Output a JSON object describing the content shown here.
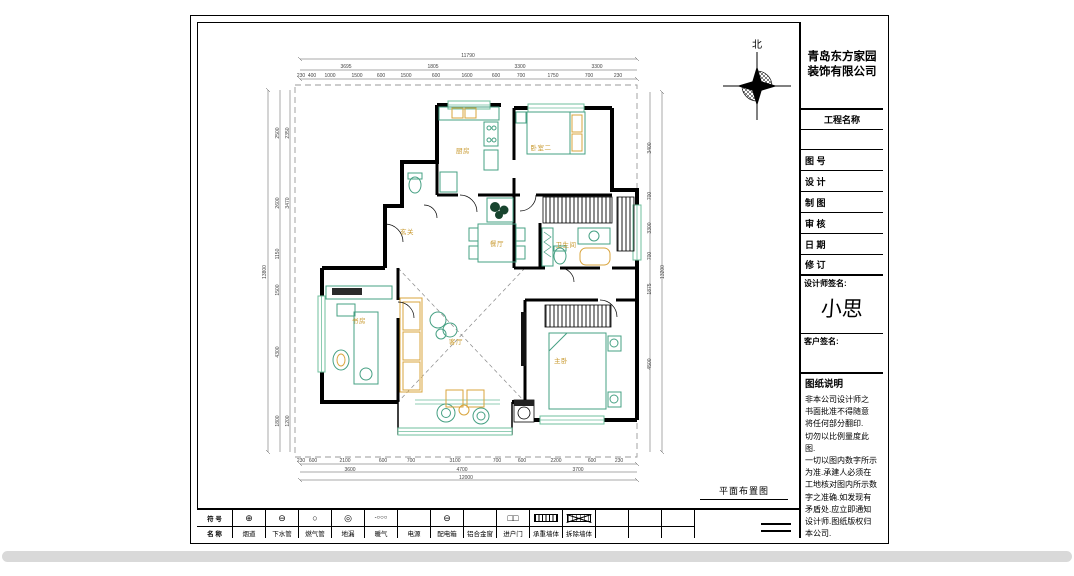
{
  "colors": {
    "wall": "#000000",
    "furniture_green": "#46a083",
    "window_green": "#6fbf9d",
    "accent_orange": "#d9a43c",
    "dim_text": "#444444",
    "room_label": "#c8992e",
    "dashed_boundary": "#9a9a9a",
    "sheet_bg": "#ffffff",
    "scrollbar": "#d9d9d9"
  },
  "north_label": "北",
  "plan_title": "平面布置图",
  "title_block": {
    "company": "青岛东方家园\n装饰有限公司",
    "project_label": "工程名称",
    "rows": [
      "图 号",
      "设 计",
      "制 图",
      "审 核",
      "日 期",
      "修 订"
    ],
    "designer_sign_label": "设计师签名:",
    "designer_signature": "小思",
    "client_sign_label": "客户签名:",
    "notes_title": "图纸说明",
    "notes": "非本公司设计师之\n书面批准不得随意\n将任何部分翻印.\n切勿以比例量度此图.\n一切以图内数字所示\n为准.承建人必须在\n工地核对图内所示数\n字之准确.如发现有\n矛盾处.应立即通知\n设计师.图纸版权归\n本公司."
  },
  "legend": {
    "row1_label": "符 号",
    "row2_label": "名 称",
    "items": [
      {
        "sym": "⊕",
        "swatch": "",
        "name": "烟道"
      },
      {
        "sym": "⊖",
        "swatch": "",
        "name": "下水管"
      },
      {
        "sym": "○",
        "swatch": "",
        "name": "燃气管"
      },
      {
        "sym": "◎",
        "swatch": "",
        "name": "地漏"
      },
      {
        "sym": "-○○○",
        "swatch": "",
        "name": "暖气"
      },
      {
        "sym": "",
        "swatch": "",
        "name": "电源"
      },
      {
        "sym": "⊖",
        "swatch": "",
        "name": "配电箱"
      },
      {
        "sym": "",
        "swatch": "",
        "name": "铝合金窗"
      },
      {
        "sym": "□□",
        "swatch": "",
        "name": "进户门"
      },
      {
        "sym": "",
        "swatch": "hatch",
        "name": "承重墙体"
      },
      {
        "sym": "",
        "swatch": "x",
        "name": "拆除墙体"
      },
      {
        "sym": "",
        "swatch": "",
        "name": ""
      },
      {
        "sym": "",
        "swatch": "",
        "name": ""
      },
      {
        "sym": "",
        "swatch": "",
        "name": ""
      }
    ]
  },
  "room_labels": [
    {
      "t": "厨房",
      "x": 463,
      "y": 153
    },
    {
      "t": "卧室二",
      "x": 541,
      "y": 150
    },
    {
      "t": "玄关",
      "x": 407,
      "y": 234
    },
    {
      "t": "餐厅",
      "x": 497,
      "y": 246
    },
    {
      "t": "卫生间",
      "x": 566,
      "y": 247
    },
    {
      "t": "书房",
      "x": 359,
      "y": 323
    },
    {
      "t": "客厅",
      "x": 456,
      "y": 344
    },
    {
      "t": "主卧",
      "x": 561,
      "y": 363
    }
  ],
  "dim_labels": [
    {
      "t": "11790",
      "x": 468,
      "y": 57
    },
    {
      "t": "3695",
      "x": 346,
      "y": 68
    },
    {
      "t": "1805",
      "x": 433,
      "y": 68
    },
    {
      "t": "3300",
      "x": 520,
      "y": 68
    },
    {
      "t": "3300",
      "x": 597,
      "y": 68
    },
    {
      "t": "230",
      "x": 301,
      "y": 77
    },
    {
      "t": "400",
      "x": 312,
      "y": 77
    },
    {
      "t": "1000",
      "x": 330,
      "y": 77
    },
    {
      "t": "1500",
      "x": 357,
      "y": 77
    },
    {
      "t": "600",
      "x": 381,
      "y": 77
    },
    {
      "t": "1500",
      "x": 406,
      "y": 77
    },
    {
      "t": "600",
      "x": 436,
      "y": 77
    },
    {
      "t": "1600",
      "x": 467,
      "y": 77
    },
    {
      "t": "600",
      "x": 496,
      "y": 77
    },
    {
      "t": "700",
      "x": 521,
      "y": 77
    },
    {
      "t": "1750",
      "x": 553,
      "y": 77
    },
    {
      "t": "700",
      "x": 589,
      "y": 77
    },
    {
      "t": "230",
      "x": 618,
      "y": 77
    },
    {
      "t": "13800",
      "x": 266,
      "y": 272,
      "r": -90
    },
    {
      "t": "2500",
      "x": 279,
      "y": 133,
      "r": -90
    },
    {
      "t": "2600",
      "x": 279,
      "y": 203,
      "r": -90
    },
    {
      "t": "1150",
      "x": 279,
      "y": 254,
      "r": -90
    },
    {
      "t": "1500",
      "x": 279,
      "y": 290,
      "r": -90
    },
    {
      "t": "4300",
      "x": 279,
      "y": 352,
      "r": -90
    },
    {
      "t": "1800",
      "x": 279,
      "y": 421,
      "r": -90
    },
    {
      "t": "2350",
      "x": 289,
      "y": 133,
      "r": -90
    },
    {
      "t": "3470",
      "x": 289,
      "y": 203,
      "r": -90
    },
    {
      "t": "1200",
      "x": 289,
      "y": 421,
      "r": -90
    },
    {
      "t": "13200",
      "x": 664,
      "y": 272,
      "r": -90
    },
    {
      "t": "3400",
      "x": 651,
      "y": 148,
      "r": -90
    },
    {
      "t": "700",
      "x": 651,
      "y": 196,
      "r": -90
    },
    {
      "t": "3300",
      "x": 651,
      "y": 228,
      "r": -90
    },
    {
      "t": "700",
      "x": 651,
      "y": 256,
      "r": -90
    },
    {
      "t": "1875",
      "x": 651,
      "y": 289,
      "r": -90
    },
    {
      "t": "4500",
      "x": 651,
      "y": 364,
      "r": -90
    },
    {
      "t": "230",
      "x": 301,
      "y": 462
    },
    {
      "t": "600",
      "x": 313,
      "y": 462
    },
    {
      "t": "2100",
      "x": 345,
      "y": 462
    },
    {
      "t": "600",
      "x": 383,
      "y": 462
    },
    {
      "t": "700",
      "x": 411,
      "y": 462
    },
    {
      "t": "3100",
      "x": 455,
      "y": 462
    },
    {
      "t": "700",
      "x": 497,
      "y": 462
    },
    {
      "t": "600",
      "x": 522,
      "y": 462
    },
    {
      "t": "2200",
      "x": 556,
      "y": 462
    },
    {
      "t": "600",
      "x": 592,
      "y": 462
    },
    {
      "t": "230",
      "x": 619,
      "y": 462
    },
    {
      "t": "3600",
      "x": 350,
      "y": 471
    },
    {
      "t": "4700",
      "x": 462,
      "y": 471
    },
    {
      "t": "3700",
      "x": 578,
      "y": 471
    },
    {
      "t": "12000",
      "x": 466,
      "y": 479
    }
  ]
}
